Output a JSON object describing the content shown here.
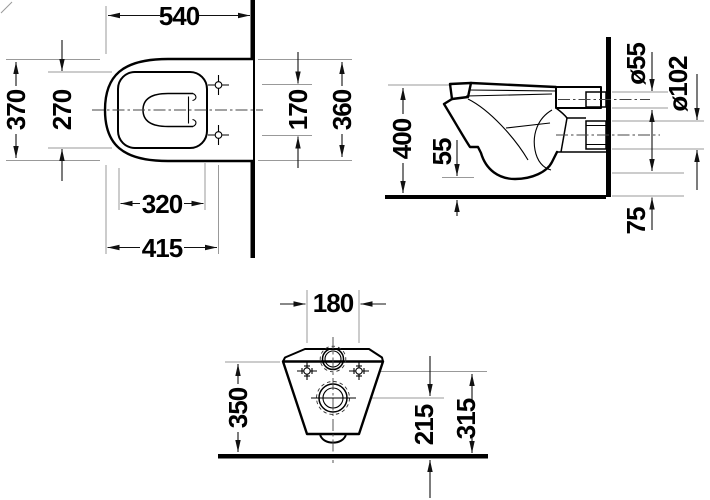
{
  "drawing": {
    "description": "Technical dimension drawing of a wall-hung toilet, three orthographic views",
    "unit": "mm",
    "colors": {
      "line": "#000000",
      "dimension": "#111111",
      "extension": "#999999",
      "background": "#ffffff"
    },
    "views": {
      "plan": {
        "name": "top view",
        "dims": {
          "overall_depth": "540",
          "overall_width": "370",
          "bowl_inner_width": "270",
          "bowl_inner_length": "320",
          "front_to_fixing_holes": "415",
          "fixing_hole_spacing": "170",
          "rear_width": "360"
        }
      },
      "side": {
        "name": "side view",
        "dims": {
          "rim_height": "400",
          "bowl_bottom_clearance": "55",
          "flush_inlet_diameter": "ø55",
          "outlet_diameter": "ø102",
          "outlet_bottom_height": "75"
        }
      },
      "front": {
        "name": "front view",
        "dims": {
          "connection_spacing": "180",
          "body_height": "350",
          "outlet_center_height": "215",
          "fixing_height": "315"
        }
      }
    }
  }
}
